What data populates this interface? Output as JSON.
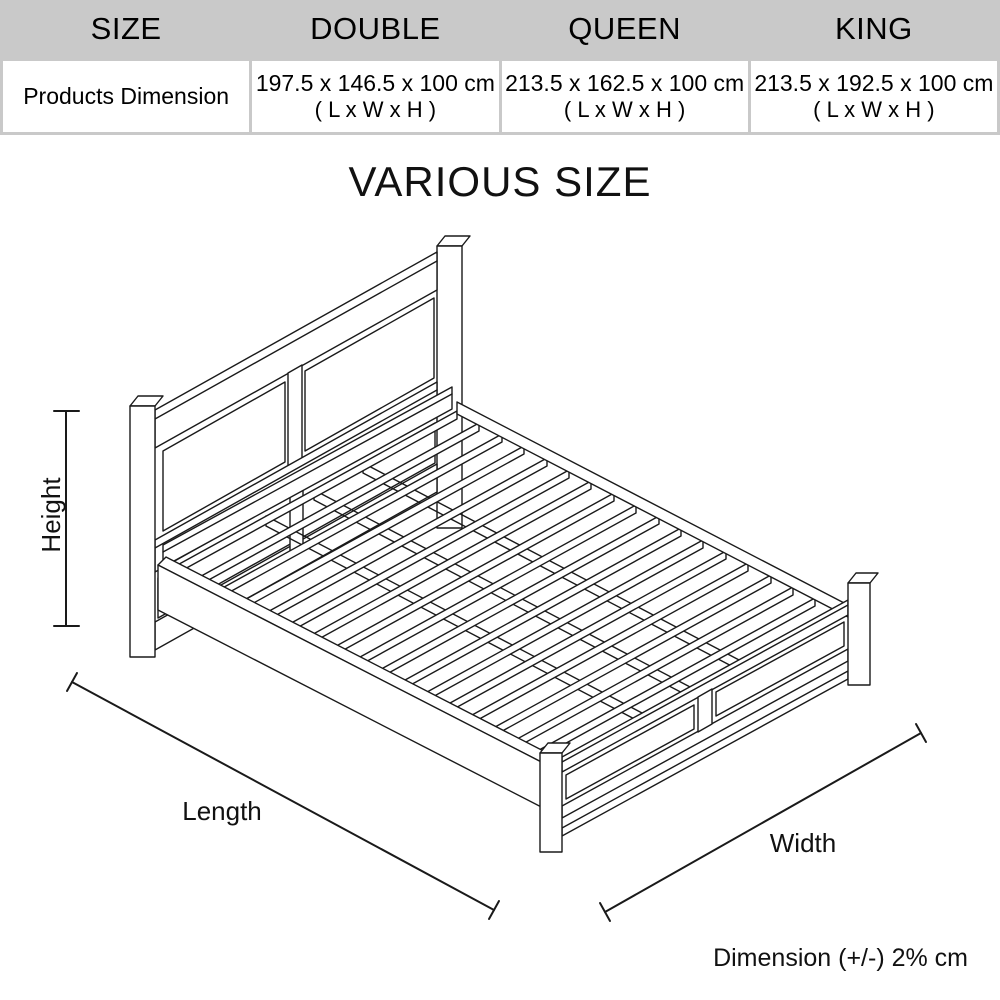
{
  "title": "VARIOUS SIZE",
  "table": {
    "header": [
      "SIZE",
      "DOUBLE",
      "QUEEN",
      "KING"
    ],
    "row_label": "Products Dimension",
    "cells": [
      {
        "dimensions": "197.5 x 146.5 x 100 cm",
        "axes": "( L x W x H )"
      },
      {
        "dimensions": "213.5 x 162.5 x 100 cm",
        "axes": "( L x W x H )"
      },
      {
        "dimensions": "213.5 x 192.5 x 100 cm",
        "axes": "( L x W x H )"
      }
    ]
  },
  "diagram": {
    "labels": {
      "height": "Height",
      "length": "Length",
      "width": "Width"
    },
    "tolerance_note": "Dimension (+/-) 2% cm"
  },
  "colors": {
    "table_header_bg": "#c9c9c9",
    "cell_bg": "#ffffff",
    "line": "#1a1a1a",
    "text": "#000000"
  }
}
